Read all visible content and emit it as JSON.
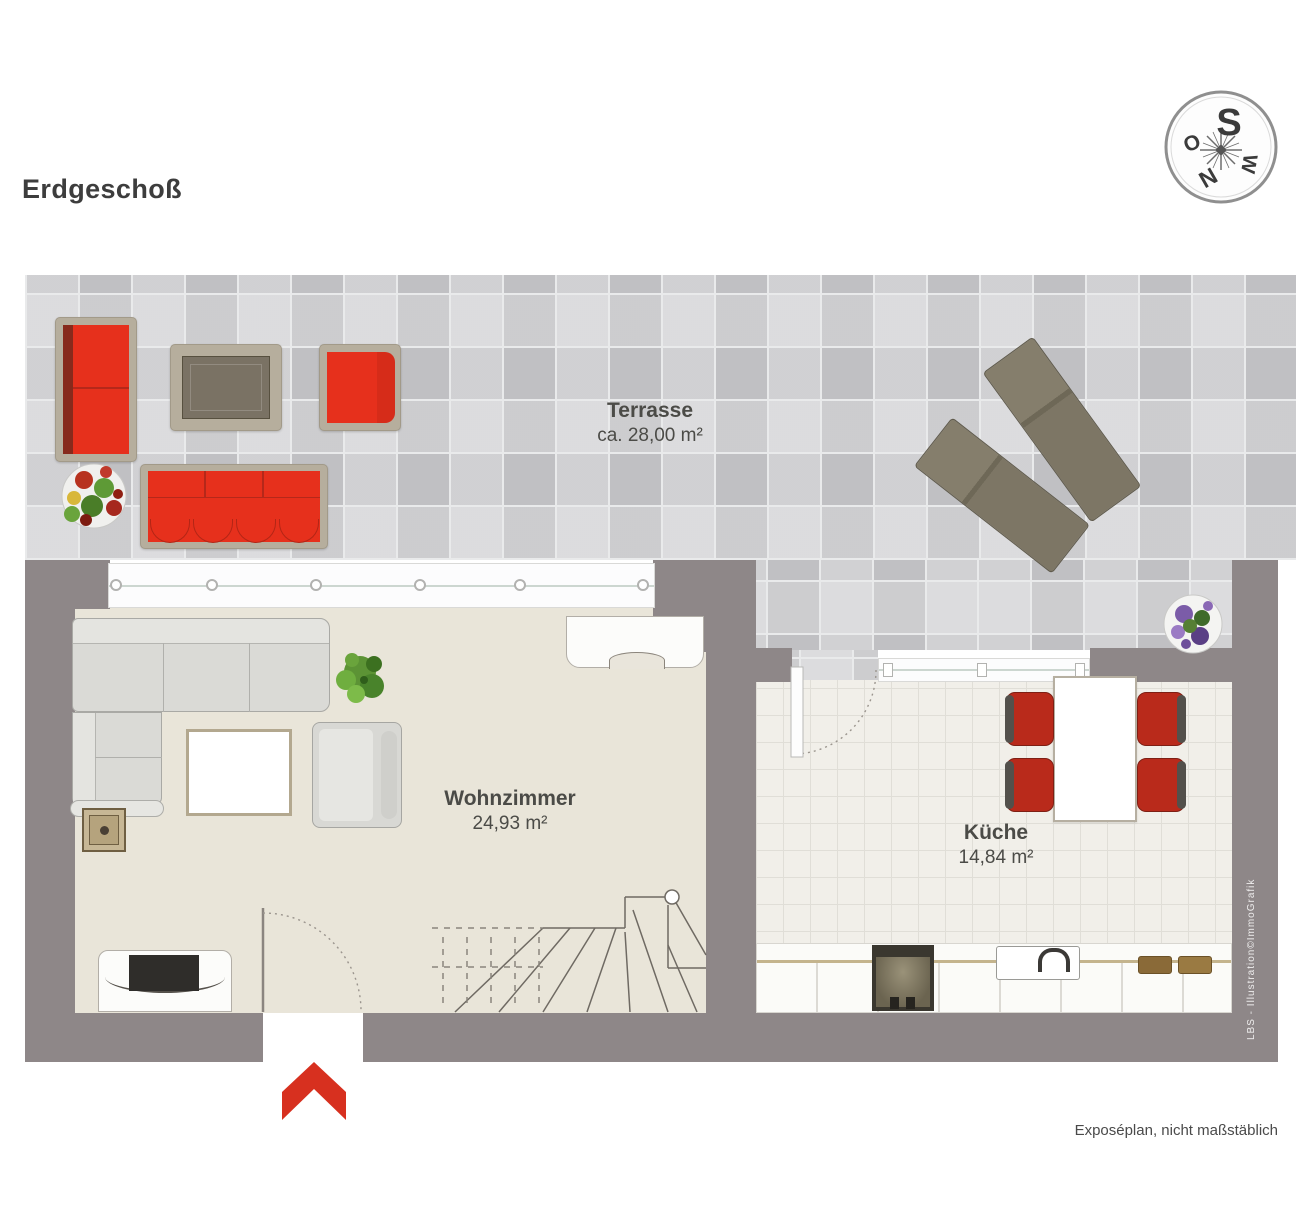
{
  "page": {
    "title": "Erdgeschoß",
    "footer_note": "Exposéplan, nicht maßstäblich",
    "credit": "LBS - Illustration©ImmoGrafik"
  },
  "compass": {
    "top": "S",
    "left": "O",
    "right": "W",
    "bottom": "N"
  },
  "rooms": [
    {
      "id": "terrasse",
      "name": "Terrasse",
      "area": "ca. 28,00 m²"
    },
    {
      "id": "wohnzimmer",
      "name": "Wohnzimmer",
      "area": "24,93 m²"
    },
    {
      "id": "kueche",
      "name": "Küche",
      "area": "14,84 m²"
    }
  ],
  "colors": {
    "accent-red": "#e6301c",
    "chair-red": "#b92a1b",
    "wall-gray": "#8e8788",
    "terrace-tile": "#d1d1d4",
    "living-floor": "#e9e5d9",
    "kitchen-floor": "#f1efe9",
    "frame-tan": "#b6ae9d",
    "lounger-olive": "#7e7867",
    "entry-arrow": "#d7301f"
  }
}
